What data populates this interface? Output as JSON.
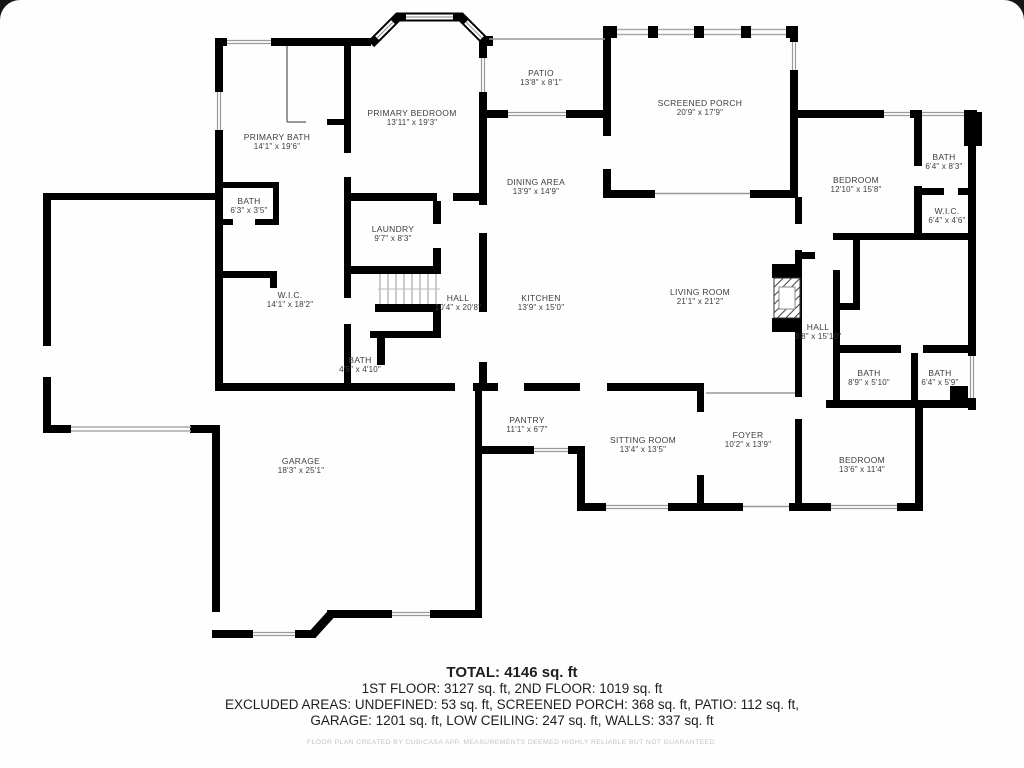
{
  "plan": {
    "rooms": [
      {
        "name": "PATIO",
        "dims": "13'8\" x 8'1\""
      },
      {
        "name": "SCREENED PORCH",
        "dims": "20'9\" x 17'9\""
      },
      {
        "name": "PRIMARY BEDROOM",
        "dims": "13'11\" x 19'3\""
      },
      {
        "name": "PRIMARY BATH",
        "dims": "14'1\" x 19'6\""
      },
      {
        "name": "BATH",
        "dims": "6'3\" x 3'5\""
      },
      {
        "name": "DINING AREA",
        "dims": "13'9\" x 14'9\""
      },
      {
        "name": "BEDROOM",
        "dims": "12'10\" x 15'8\""
      },
      {
        "name": "BATH",
        "dims": "6'4\" x 8'3\""
      },
      {
        "name": "W.I.C.",
        "dims": "6'4\" x 4'6\""
      },
      {
        "name": "LAUNDRY",
        "dims": "9'7\" x 8'3\""
      },
      {
        "name": "W.I.C.",
        "dims": "14'1\" x 18'2\""
      },
      {
        "name": "HALL",
        "dims": "10'4\" x 20'8\""
      },
      {
        "name": "KITCHEN",
        "dims": "13'9\" x 15'0\""
      },
      {
        "name": "LIVING ROOM",
        "dims": "21'1\" x 21'2\""
      },
      {
        "name": "HALL",
        "dims": "3'8\" x 15'10\""
      },
      {
        "name": "BATH",
        "dims": "4'5\" x 4'10\""
      },
      {
        "name": "BATH",
        "dims": "8'9\" x 5'10\""
      },
      {
        "name": "BATH",
        "dims": "6'4\" x 5'9\""
      },
      {
        "name": "PANTRY",
        "dims": "11'1\" x 6'7\""
      },
      {
        "name": "SITTING ROOM",
        "dims": "13'4\" x 13'5\""
      },
      {
        "name": "FOYER",
        "dims": "10'2\" x 13'9\""
      },
      {
        "name": "BEDROOM",
        "dims": "13'6\" x 11'4\""
      },
      {
        "name": "GARAGE",
        "dims": "18'3\" x 25'1\""
      }
    ],
    "footer": {
      "total": "TOTAL: 4146 sq. ft",
      "floors": "1ST FLOOR: 3127 sq. ft, 2ND FLOOR: 1019 sq. ft",
      "excluded1": "EXCLUDED AREAS: UNDEFINED: 53 sq. ft, SCREENED PORCH: 368 sq. ft, PATIO: 112 sq. ft,",
      "excluded2": "GARAGE: 1201 sq. ft, LOW CEILING: 247 sq. ft, WALLS: 337 sq. ft",
      "disclaimer": "FLOOR PLAN CREATED BY CUBICASA APP. MEASUREMENTS DEEMED HIGHLY RELIABLE BUT NOT GUARANTEED."
    },
    "wall_color": "#000000",
    "window_line_color": "#9a9a9a"
  }
}
